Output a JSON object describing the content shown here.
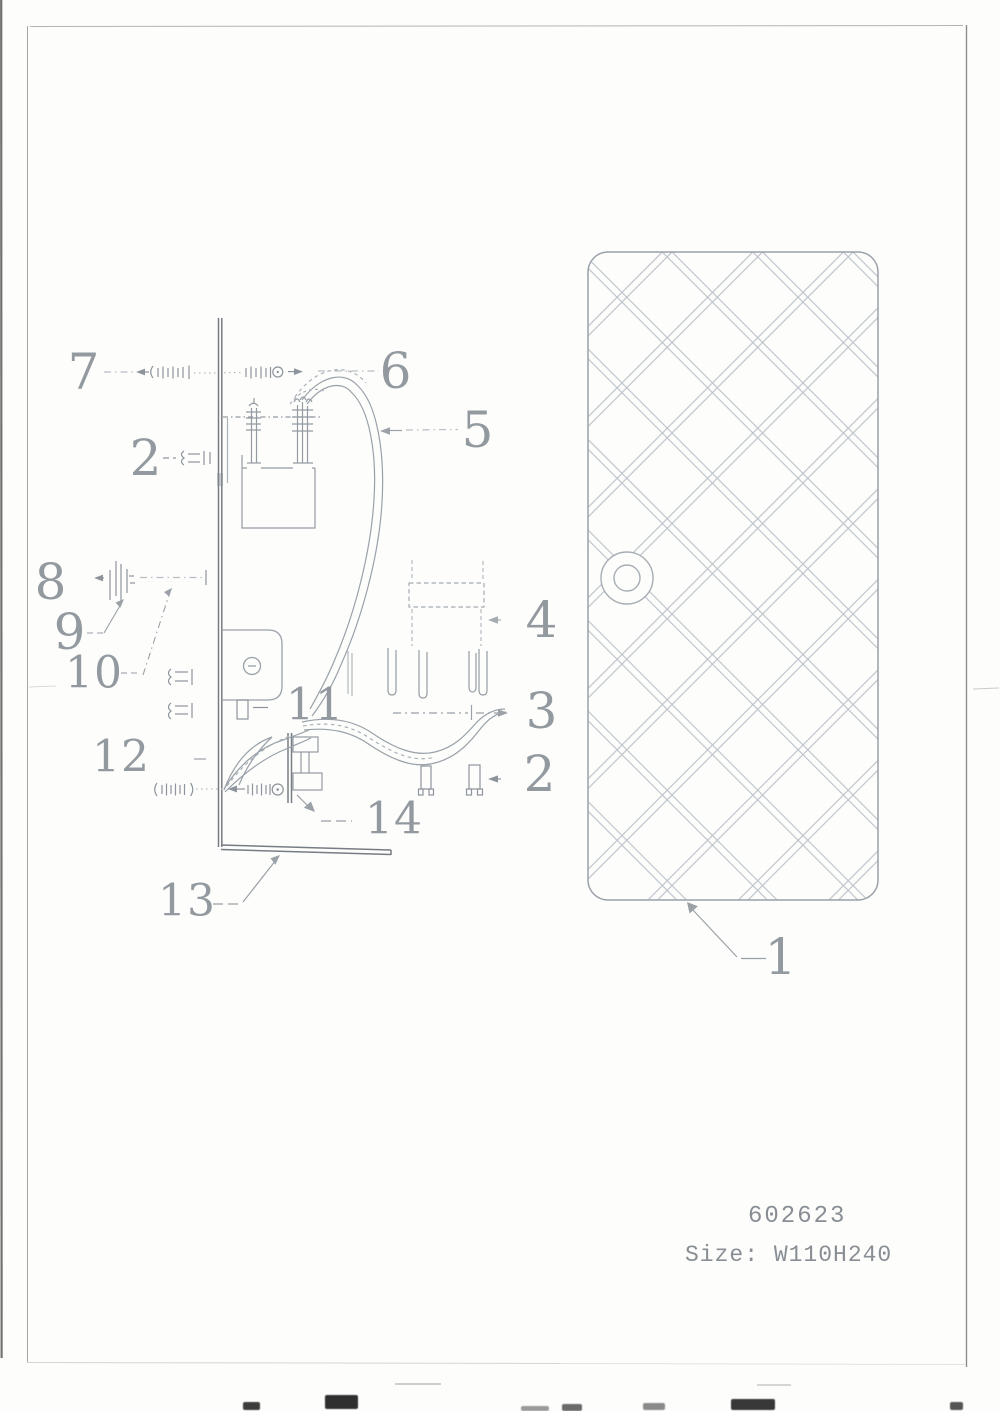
{
  "document": {
    "footer": {
      "model_code": "602623",
      "size_label": "Size: W110H240"
    }
  },
  "diagram": {
    "callouts": {
      "c1": "1",
      "c2_upper": "2",
      "c2_lower": "2",
      "c3": "3",
      "c4": "4",
      "c5": "5",
      "c6": "6",
      "c7": "7",
      "c8": "8",
      "c9": "9",
      "c10": "10",
      "c11": "11",
      "c12": "12",
      "c13": "13",
      "c14": "14"
    }
  },
  "colors": {
    "paper": "#fdfdfc",
    "line": "#8f979e",
    "line_dark": "#6f767d",
    "line_light": "#b8bfc5",
    "lattice": "#bcc3c9",
    "callout_text": "#8b9298",
    "footer_text": "#80868c"
  }
}
